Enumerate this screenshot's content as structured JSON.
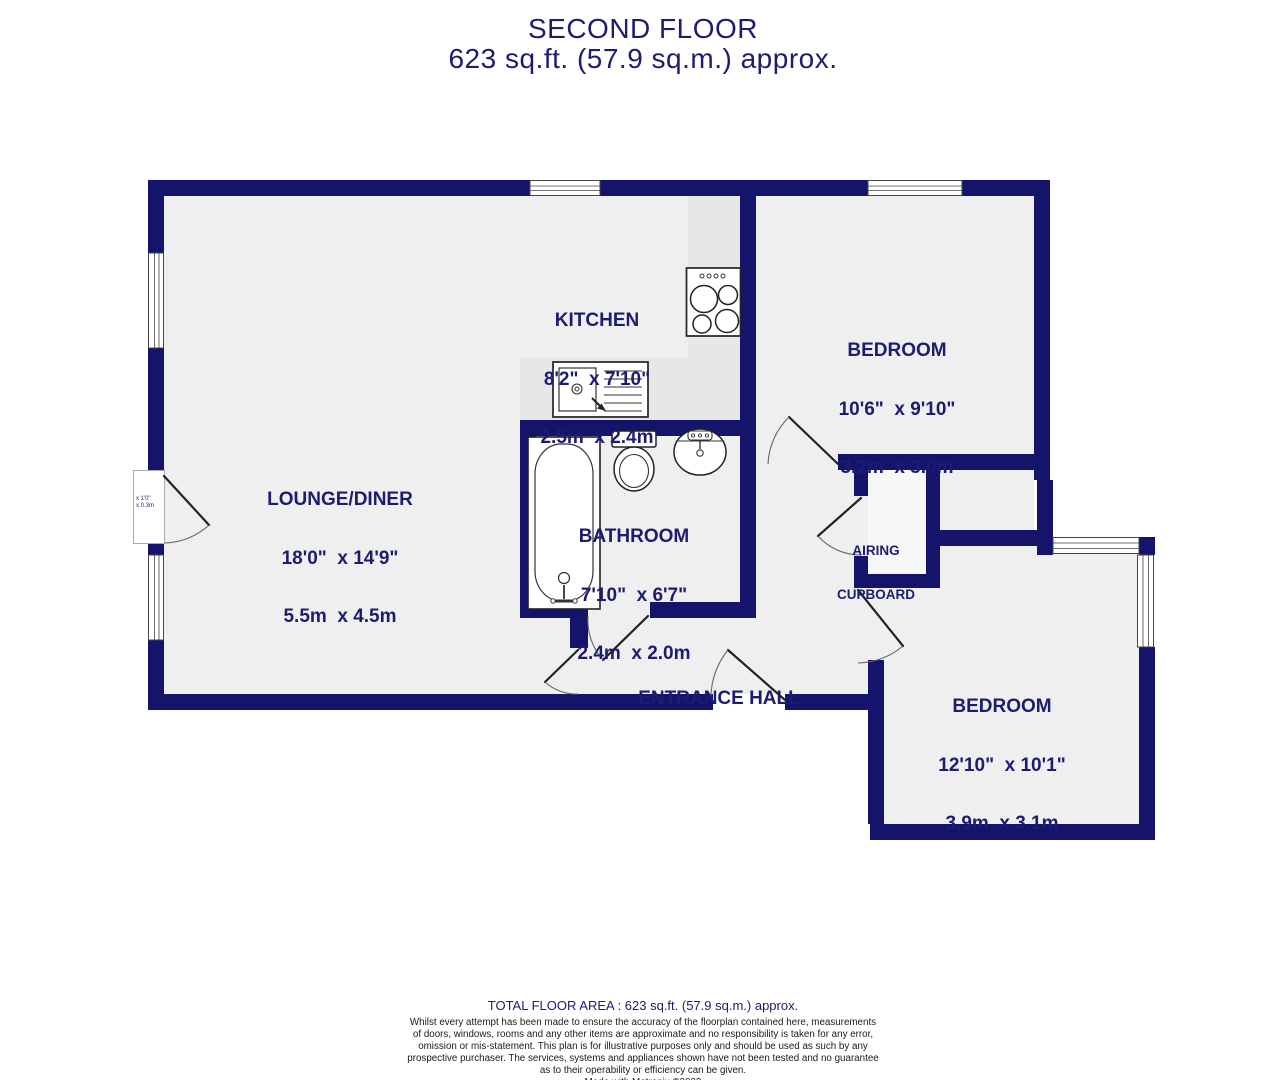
{
  "header": {
    "line1": "SECOND FLOOR",
    "line2": "623 sq.ft. (57.9 sq.m.) approx."
  },
  "rooms": [
    {
      "name": "KITCHEN",
      "imperial": "8'2\"  x 7'10\"",
      "metric": "2.5m  x 2.4m"
    },
    {
      "name": "BEDROOM",
      "imperial": "10'6\"  x 9'10\"",
      "metric": "3.2m  x 3.0m"
    },
    {
      "name": "LOUNGE/DINER",
      "imperial": "18'0\"  x 14'9\"",
      "metric": "5.5m  x 4.5m"
    },
    {
      "name": "BATHROOM",
      "imperial": "7'10\"  x 6'7\"",
      "metric": "2.4m  x 2.0m"
    },
    {
      "name_line1": "AIRING",
      "name_line2": "CUPBOARD"
    },
    {
      "name": "ENTRANCE HALL"
    },
    {
      "name": "BEDROOM",
      "imperial": "12'10\"  x 10'1\"",
      "metric": "3.9m  x 3.1m"
    }
  ],
  "recess_label": {
    "line1": "x 1'0\"",
    "line2": "x 0.3m"
  },
  "footer": {
    "total": "TOTAL FLOOR AREA : 623 sq.ft. (57.9 sq.m.) approx.",
    "disclaimer_lines": [
      "Whilst every attempt has been made to ensure the accuracy of the floorplan contained here, measurements",
      "of doors, windows, rooms and any other items are approximate and no responsibility is taken for any error,",
      "omission or mis-statement. This plan is for illustrative purposes only and should be used as such by any",
      "prospective purchaser. The services, systems and appliances shown have not been tested and no guarantee",
      "as to their operability or efficiency can be given."
    ],
    "credit": "Made with Metropix ©2023"
  },
  "colors": {
    "wall": "#14146b",
    "text": "#1c1c70",
    "floor": "#efefef",
    "counter": "#e7e7e7"
  }
}
